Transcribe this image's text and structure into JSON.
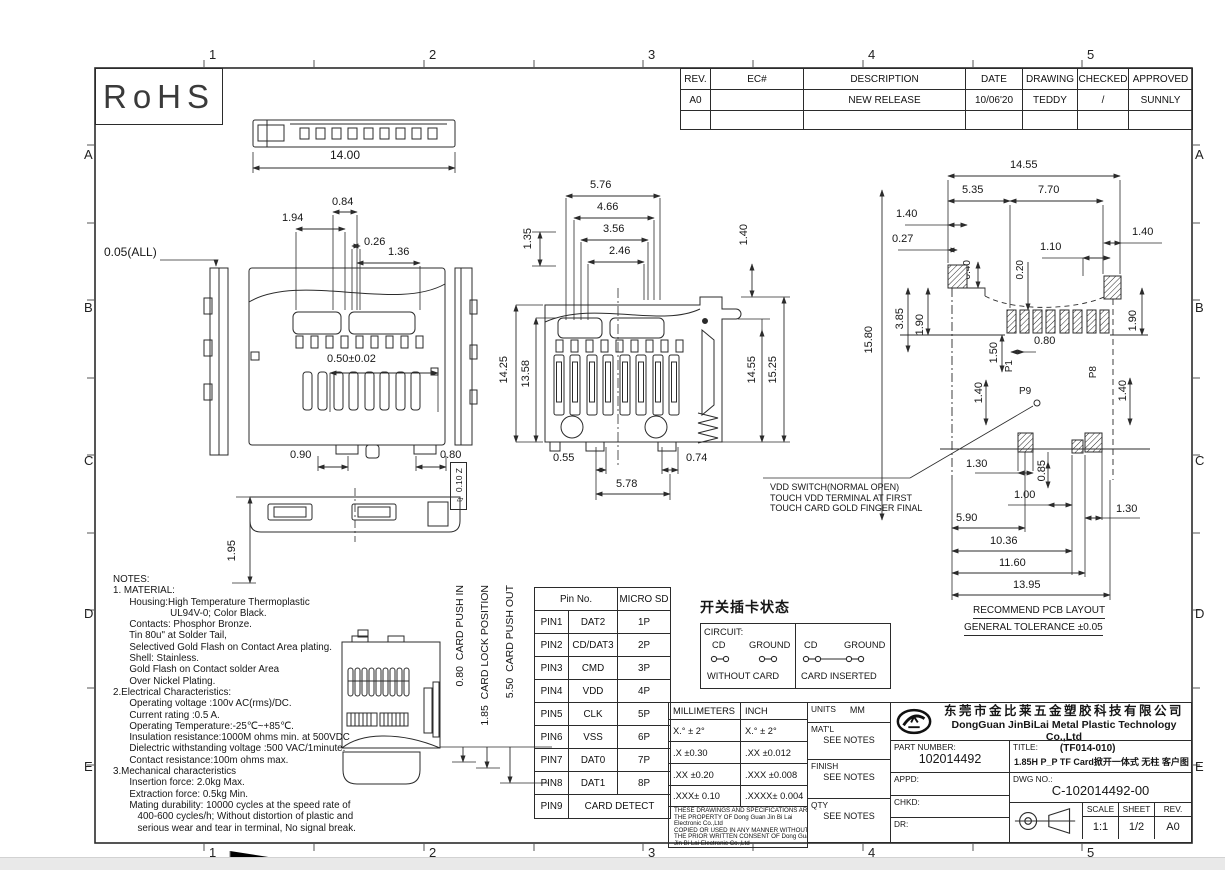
{
  "grid": {
    "cols": [
      "1",
      "2",
      "3",
      "4",
      "5"
    ],
    "rows": [
      "A",
      "B",
      "C",
      "D",
      "E"
    ]
  },
  "rohs_label": "RoHS",
  "rev_table": {
    "headers": [
      "REV.",
      "EC#",
      "DESCRIPTION",
      "DATE",
      "DRAWING",
      "CHECKED",
      "APPROVED"
    ],
    "row": [
      "A0",
      "",
      "NEW RELEASE",
      "10/06'20",
      "TEDDY",
      "/",
      "SUNNLY"
    ]
  },
  "dims": {
    "tv_w": "14.00",
    "fv1": "0.84",
    "fv2": "1.94",
    "fv3": "0.26",
    "fv4": "1.36",
    "fv_all": "0.05(ALL)",
    "fv_pitch": "0.50±0.02",
    "fv_b1": "0.90",
    "fv_b2": "0.80",
    "bv_h": "1.95",
    "flatness_callout": "▱ 0.10 Z",
    "mv1": "5.76",
    "mv2": "4.66",
    "mv3": "3.56",
    "mv4": "2.46",
    "mv5": "1.35",
    "mv6": "1.40",
    "mv7": "14.25",
    "mv8": "13.58",
    "mv9": "14.55",
    "mv10": "15.25",
    "mv11": "0.55",
    "mv12": "0.74",
    "mv13": "5.78",
    "pb1": "14.55",
    "pb2": "5.35",
    "pb3": "7.70",
    "pb4": "1.40",
    "pb5": "0.27",
    "pb6": "1.10",
    "pb7": "1.40",
    "pb8": "0.40",
    "pb9": "0.20",
    "pb10": "3.85",
    "pb11": "1.90",
    "pb12": "15.80",
    "pb13": "1.50",
    "pb14": "0.80",
    "pb15": "1.90",
    "pb16": "P1",
    "pb17": "P8",
    "pb18": "P9",
    "pb19": "1.40",
    "pb20": "1.40",
    "pb21": "1.30",
    "pb22": "0.85",
    "pb23": "1.00",
    "pb24": "5.90",
    "pb25": "1.30",
    "pb26": "10.36",
    "pb27": "11.60",
    "pb28": "13.95"
  },
  "vdd_note": "VDD SWITCH(NORMAL OPEN)\nTOUCH VDD TERMINAL AT FIRST\nTOUCH CARD GOLD FINGER FINAL",
  "pcb_caption": {
    "line1": "RECOMMEND PCB LAYOUT",
    "line2": "GENERAL TOLERANCE ±0.05"
  },
  "card_travel": {
    "push_in": "0.80  CARD PUSH IN",
    "lock": "1.85  CARD LOCK POSITION",
    "push_out": "5.50  CARD PUSH OUT"
  },
  "notes": "NOTES:\n1. MATERIAL:\n      Housing:High Temperature Thermoplastic\n                     UL94V-0; Color Black.\n      Contacts: Phosphor Bronze.\n      Tin 80u\" at Solder Tail,\n      Selectived Gold Flash on Contact Area plating.\n      Shell: Stainless.\n      Gold Flash on Contact solder Area\n      Over Nickel Plating.\n2.Electrical Characteristics:\n      Operating voltage :100v AC(rms)/DC.\n      Current rating :0.5 A.\n      Operating Temperature:-25℃~+85℃.\n      Insulation resistance:1000M ohms min. at 500VDC\n      Dielectric withstanding voltage :500 VAC/1minute.\n      Contact resistance:100m ohms max.\n3.Mechanical characteristics\n      Insertion force: 2.0kg Max.\n      Extraction force: 0.5kg Min.\n      Mating durability: 10000 cycles at the speed rate of\n         400-600 cycles/h; Without distortion of plastic and\n         serious wear and tear in terminal, No signal break.",
  "pin_table": {
    "header_pin": "Pin No.",
    "header_sd": "MICRO SD",
    "rows": [
      [
        "PIN1",
        "DAT2",
        "1P"
      ],
      [
        "PIN2",
        "CD/DAT3",
        "2P"
      ],
      [
        "PIN3",
        "CMD",
        "3P"
      ],
      [
        "PIN4",
        "VDD",
        "4P"
      ],
      [
        "PIN5",
        "CLK",
        "5P"
      ],
      [
        "PIN6",
        "VSS",
        "6P"
      ],
      [
        "PIN7",
        "DAT0",
        "7P"
      ],
      [
        "PIN8",
        "DAT1",
        "8P"
      ]
    ],
    "pin9": [
      "PIN9",
      "CARD DETECT"
    ]
  },
  "switch_diagram": {
    "title": "开关插卡状态",
    "circuit_label": "CIRCUIT:",
    "cd_label": "CD",
    "ground_label": "GROUND",
    "without_card": "WITHOUT CARD",
    "card_inserted": "CARD INSERTED"
  },
  "tol_table": {
    "headers": [
      "MILLIMETERS",
      "INCH"
    ],
    "rows": [
      [
        "X.°  ± 2°",
        "X.°  ± 2°"
      ],
      [
        ".X   ±0.30",
        ".XX   ±0.012"
      ],
      [
        ".XX  ±0.20",
        ".XXX  ±0.008"
      ],
      [
        ".XXX± 0.10",
        ".XXXX± 0.004"
      ]
    ],
    "disclaimer": "THESE DRAWINGS AND SPECIFICATIONS ARE\nTHE PROPERTY OF Dong Guan Jin Bi Lai\nElectronic Co.,Ltd\nCOPIED OR USED IN ANY MANNER WITHOUT\nTHE PRIOR WRITTEN CONSENT OF Dong Guan\nJin Bi Lai Electronic Co.,Ltd"
  },
  "units_block": {
    "units_label": "UNITS",
    "units_value": "MM",
    "matl_label": "MAT'L",
    "finish_label": "FINISH",
    "qty_label": "QTY",
    "see_notes": "SEE NOTES"
  },
  "title_block": {
    "company_cn": "东莞市金比莱五金塑胶科技有限公司",
    "company_en": "DongGuan JinBiLai Metal Plastic Technology Co.,Ltd",
    "part_number_label": "PART NUMBER:",
    "part_number": "102014492",
    "title_label": "TITLE:",
    "title_line1": "(TF014-010)",
    "title_line2": "1.85H P_P TF Card掀开一体式 无柱 客户图",
    "appd_label": "APPD:",
    "chkd_label": "CHKD:",
    "dr_label": "DR:",
    "dwg_no_label": "DWG NO.:",
    "dwg_no": "C-102014492-00",
    "scale_label": "SCALE",
    "scale_value": "1:1",
    "sheet_label": "SHEET",
    "sheet_value": "1/2",
    "rev_label": "REV.",
    "rev_value": "A0"
  }
}
